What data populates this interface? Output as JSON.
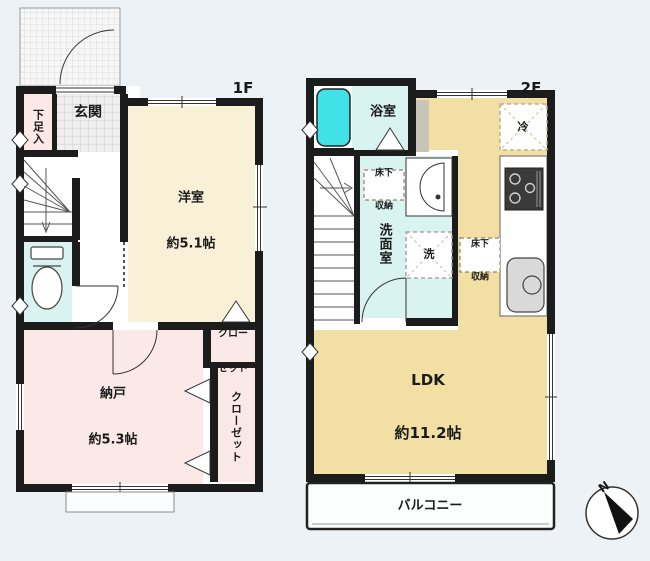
{
  "plan": {
    "floor1": {
      "label": "1F",
      "entrance": "玄関",
      "shoe_box": "下足入",
      "western_room": {
        "name": "洋室",
        "size": "約5.1帖"
      },
      "closet_upper": {
        "line1": "クロー",
        "line2": "ゼット"
      },
      "storage_room": {
        "name": "納戸",
        "size": "約5.3帖"
      },
      "closet_side": "クローゼット"
    },
    "floor2": {
      "label": "2F",
      "bathroom": "浴室",
      "washroom": "洗面室",
      "washer": "洗",
      "refrigerator": "冷",
      "underfloor_storage_washroom": {
        "line1": "床下",
        "line2": "収納"
      },
      "underfloor_storage_ldk": {
        "line1": "床下",
        "line2": "収納"
      },
      "ldk": {
        "name": "LDK",
        "size": "約11.2帖"
      },
      "balcony": "バルコニー"
    },
    "compass": {
      "north": "N"
    },
    "colors": {
      "background": "#edf2f6",
      "wall": "#1c1c1c",
      "western_room": "#f8f1d7",
      "storage_pink": "#fbe9e7",
      "ldk": "#f2dfa3",
      "wet_room": "#d9f3f0",
      "bathtub": "#40e2e8"
    }
  }
}
